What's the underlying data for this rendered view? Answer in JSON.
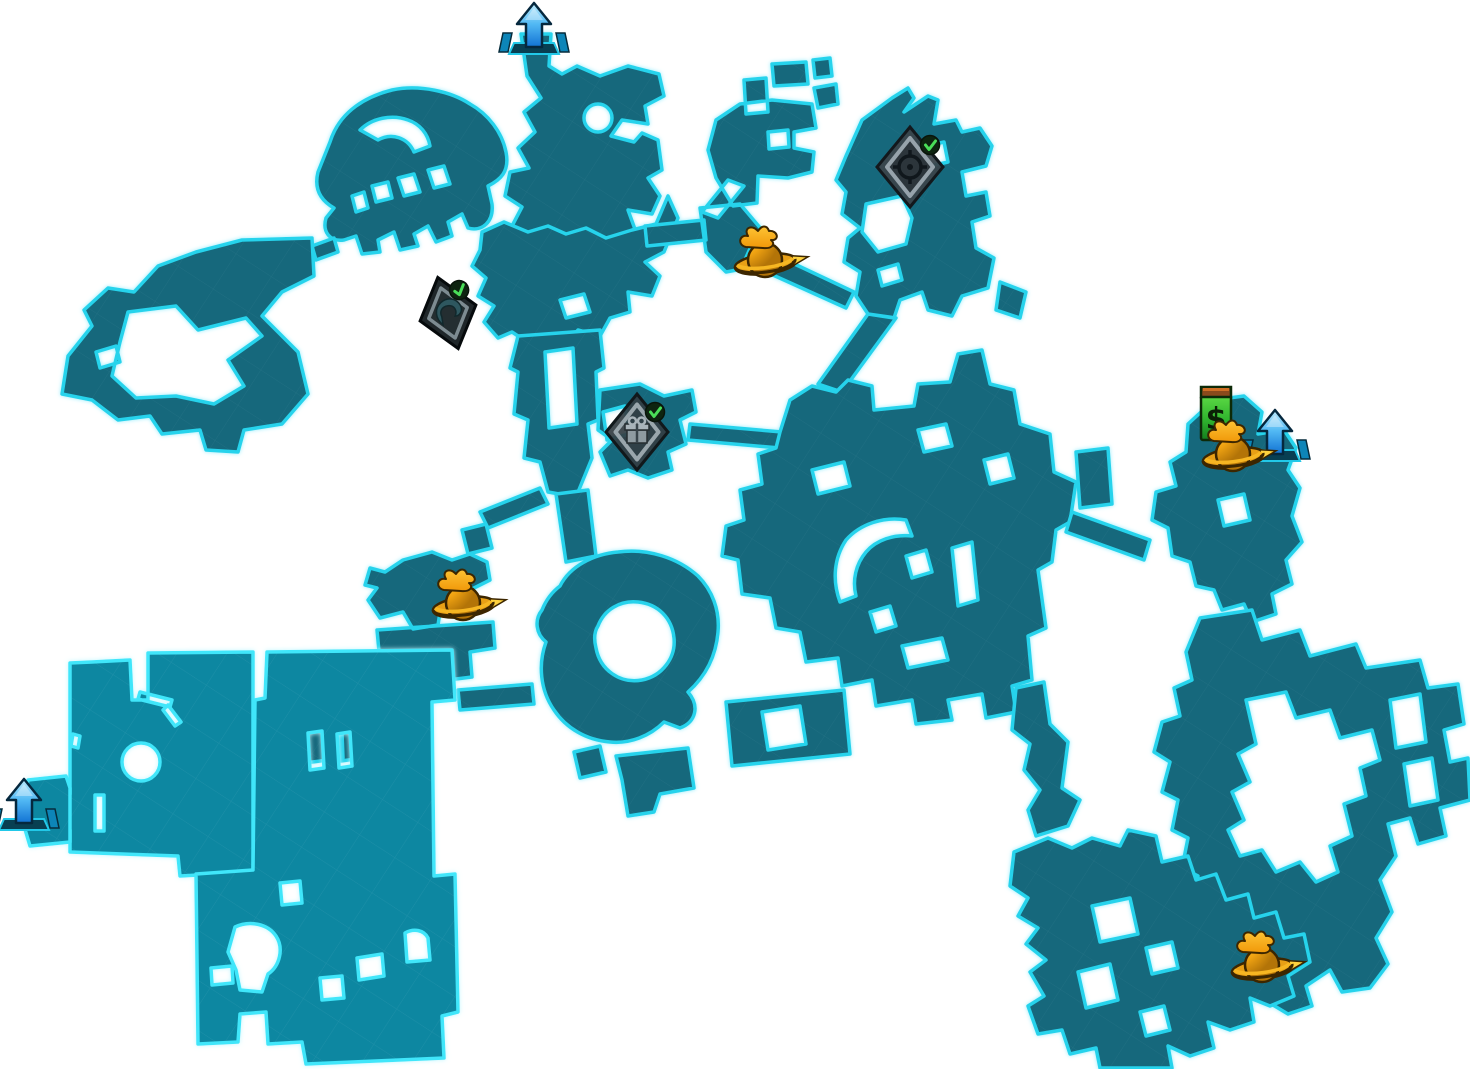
{
  "app": {
    "title": "In-game world map (explored areas on white background)"
  },
  "map": {
    "background_color": "#ffffff",
    "explored_zone_fill": "#14677b",
    "explored_zone_outline": "#27d3ec",
    "highlight_zone_fill": "#0d87a1",
    "highlight_zone_outline": "#3fe6fa",
    "vending_symbol": "$",
    "icon_colors": {
      "transition_arrow_blue_top": "#b9e9fc",
      "transition_arrow_blue_bottom": "#0e6fd2",
      "marker_orange": "#f0a312",
      "vending_green": "#2fb32e",
      "vending_cap_brown": "#8a4a1c",
      "check_green": "#4ade58",
      "diamond_gray": "#3a444b"
    },
    "icons": [
      {
        "name": "vending-machine-money",
        "type": "vending-machine",
        "x": 1216,
        "y": 414
      },
      {
        "name": "exit-north-arrow",
        "type": "transition-arrow",
        "x": 534,
        "y": 30
      },
      {
        "name": "exit-east-arrow",
        "type": "transition-arrow",
        "x": 1275,
        "y": 437
      },
      {
        "name": "exit-west-arrow",
        "type": "transition-arrow",
        "x": 24,
        "y": 806
      },
      {
        "name": "challenge-target-completed",
        "type": "diamond-target",
        "x": 910,
        "y": 167,
        "completed": true
      },
      {
        "name": "challenge-claw-completed",
        "type": "diamond-claw",
        "x": 448,
        "y": 313,
        "rotate": -16,
        "completed": true
      },
      {
        "name": "challenge-gift-completed",
        "type": "diamond-gift",
        "x": 637,
        "y": 432,
        "completed": true
      },
      {
        "name": "typhon-marker-north",
        "type": "typhon-marker",
        "x": 765,
        "y": 258
      },
      {
        "name": "typhon-marker-west",
        "type": "typhon-marker",
        "x": 463,
        "y": 601
      },
      {
        "name": "typhon-marker-east",
        "type": "typhon-marker",
        "x": 1233,
        "y": 452
      },
      {
        "name": "typhon-marker-southeast",
        "type": "typhon-marker",
        "x": 1262,
        "y": 963
      }
    ]
  }
}
